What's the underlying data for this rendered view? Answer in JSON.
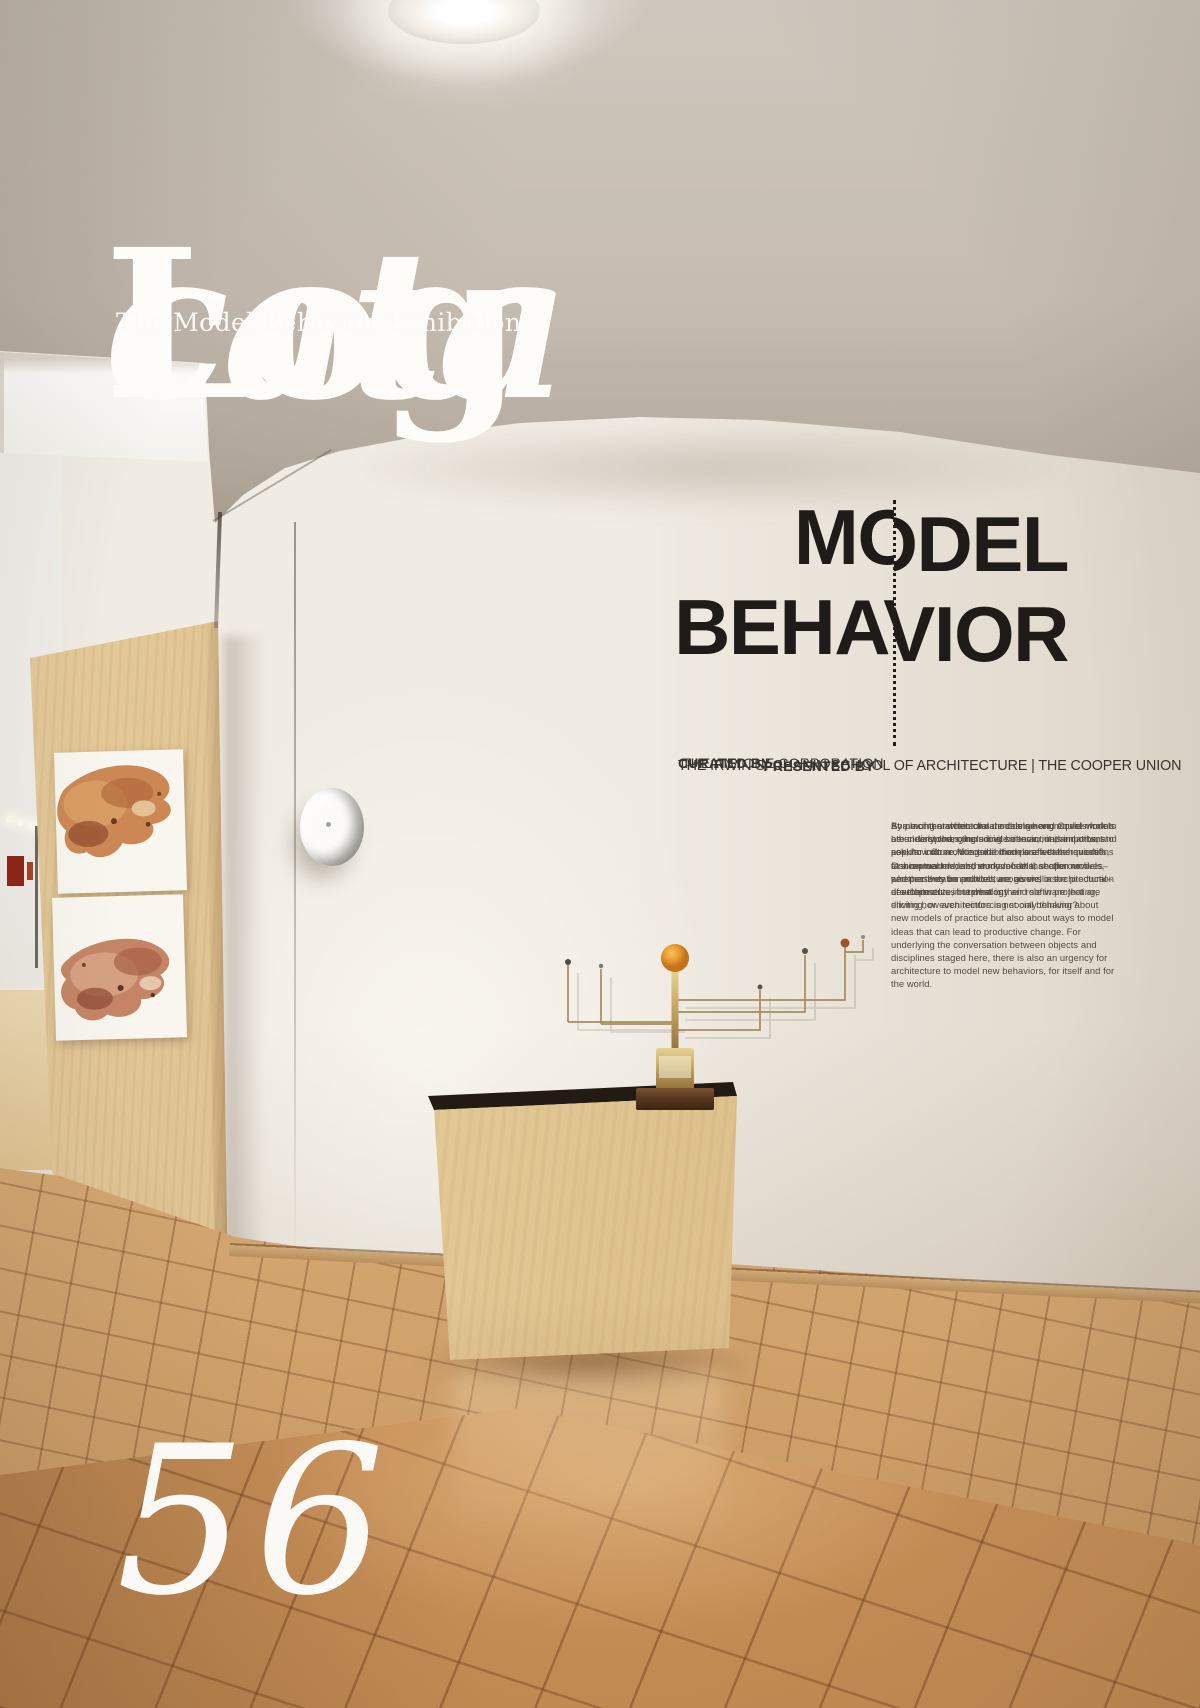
{
  "cover": {
    "masthead_italic": "cata",
    "masthead_regular": "Log",
    "subtitle": "The Model Behavior Exhibition",
    "issue_number": "56"
  },
  "wall_text": {
    "headline_line1": "MODEL",
    "headline_line2": "BEHAVIOR",
    "curated_label": "CURATED BY",
    "curated_value": "THE ANYONE CORPORATION",
    "presented_label": "PRESENTED BY",
    "presented_value": "THE IRWIN S. CHANIN SCHOOL OF ARCHITECTURE | THE COOPER UNION",
    "paragraphs": [
      "At a moment when climate change and Covid models are clearly changing social behavior, it is important to ask, how do architectural models affect behaviors? Conceptual models, study models, section models, and presentation models are givens in the production of architecture, but what is their role in projecting, eliciting, or even reinforcing social behavior?",
      "By placing architectural models among models from other disciplines, including science, mathematics, and popular culture, this exhibition poses these questions at a moment when the models that shape our lives–whether they be political, economic, or architectural–are themselves in question.",
      "Some of the architectural models here require work to be understood, others invite interaction, and others seek to inform. Alongside them are weather models, fashion models, and works of art that offer new perspectives on architecture, as well as developments in technology and software that are driving how architecture is not only thinking about new models of practice but also about ways to model ideas that can lead to productive change. For underlying the conversation between objects and disciplines staged here, there is also an urgency for architecture to model new behaviors, for itself and for the world."
    ]
  },
  "colors": {
    "ceiling": "#c6bcb1",
    "wall": "#f0ebe3",
    "headline_text": "#1f1b18",
    "body_text": "#524c45",
    "masthead_text": "#fdfcf9",
    "plywood": "#d8b987",
    "floor_tile": "#c8915a",
    "red_accent": "#8e2418"
  }
}
